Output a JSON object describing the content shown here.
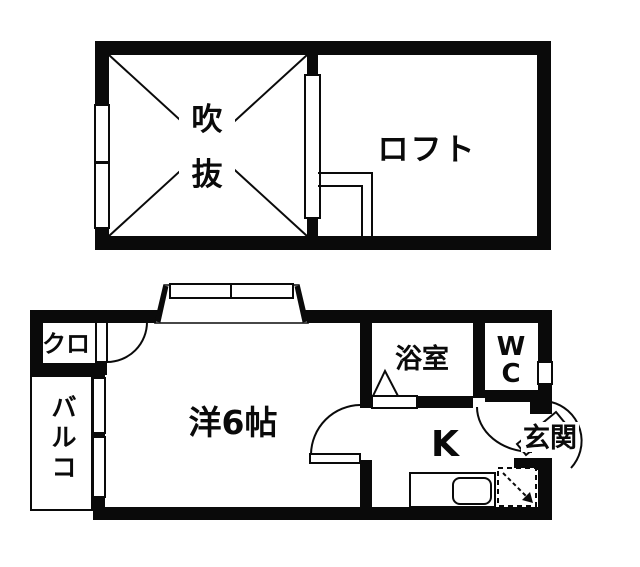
{
  "floorplan": {
    "background": "#ffffff",
    "line_color": "#0a0a0a",
    "upper_floor": {
      "void_room": {
        "label": "吹抜",
        "label_chars": [
          "吹",
          "抜"
        ]
      },
      "loft": {
        "label": "ロフト"
      }
    },
    "lower_floor": {
      "closet": {
        "label": "クロ"
      },
      "balcony": {
        "label": "バルコ",
        "label_chars": [
          "バ",
          "ル",
          "コ"
        ]
      },
      "western_room": {
        "label": "洋6帖"
      },
      "bathroom": {
        "label": "浴室"
      },
      "toilet": {
        "label": "WC",
        "label_chars": [
          "W",
          "C"
        ]
      },
      "kitchen": {
        "label": "K"
      },
      "entrance": {
        "label": "玄関"
      }
    }
  }
}
